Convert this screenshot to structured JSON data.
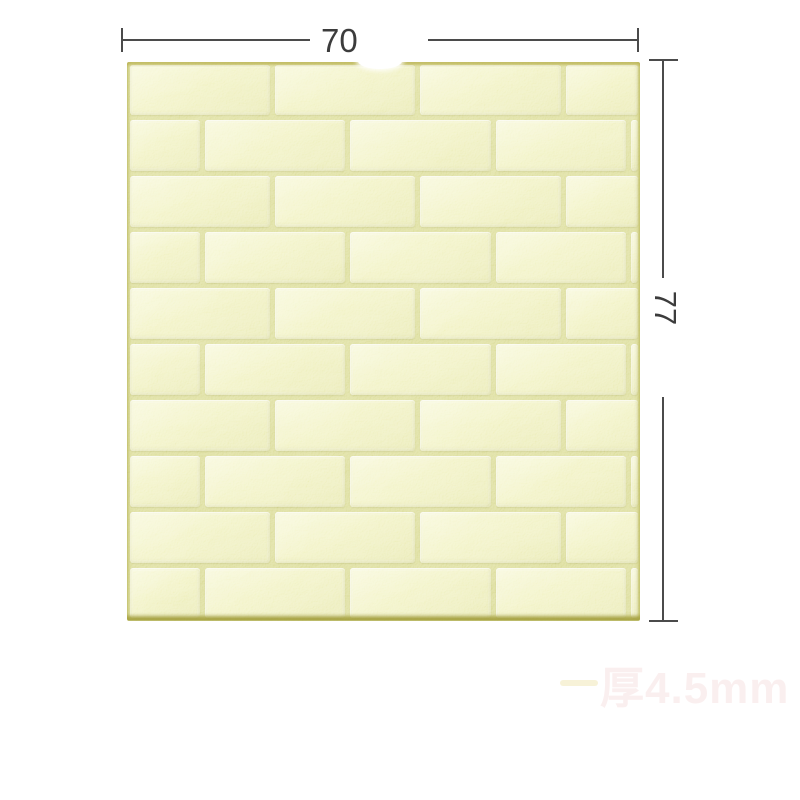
{
  "dimensions": {
    "width": {
      "label": "70"
    },
    "height": {
      "label": "77"
    }
  },
  "watermark": {
    "text": "厚4.5mm"
  },
  "panel": {
    "rows": 10,
    "row_height": 55.9,
    "mortar_gap": 5,
    "row_patterns": {
      "a": [
        145,
        145,
        146,
        77
      ],
      "b": [
        75,
        145,
        146,
        135,
        12
      ]
    },
    "colors": {
      "brick": "#e9eaa4",
      "brick_highlight": "#f3f4c6",
      "brick_shadow": "#dcdd8e",
      "mortar": "#c9cb70",
      "panel_edge": "#bdbb5e"
    }
  },
  "annotation": {
    "line_color": "#4b4b4b",
    "text_color": "#3c3c3c"
  }
}
